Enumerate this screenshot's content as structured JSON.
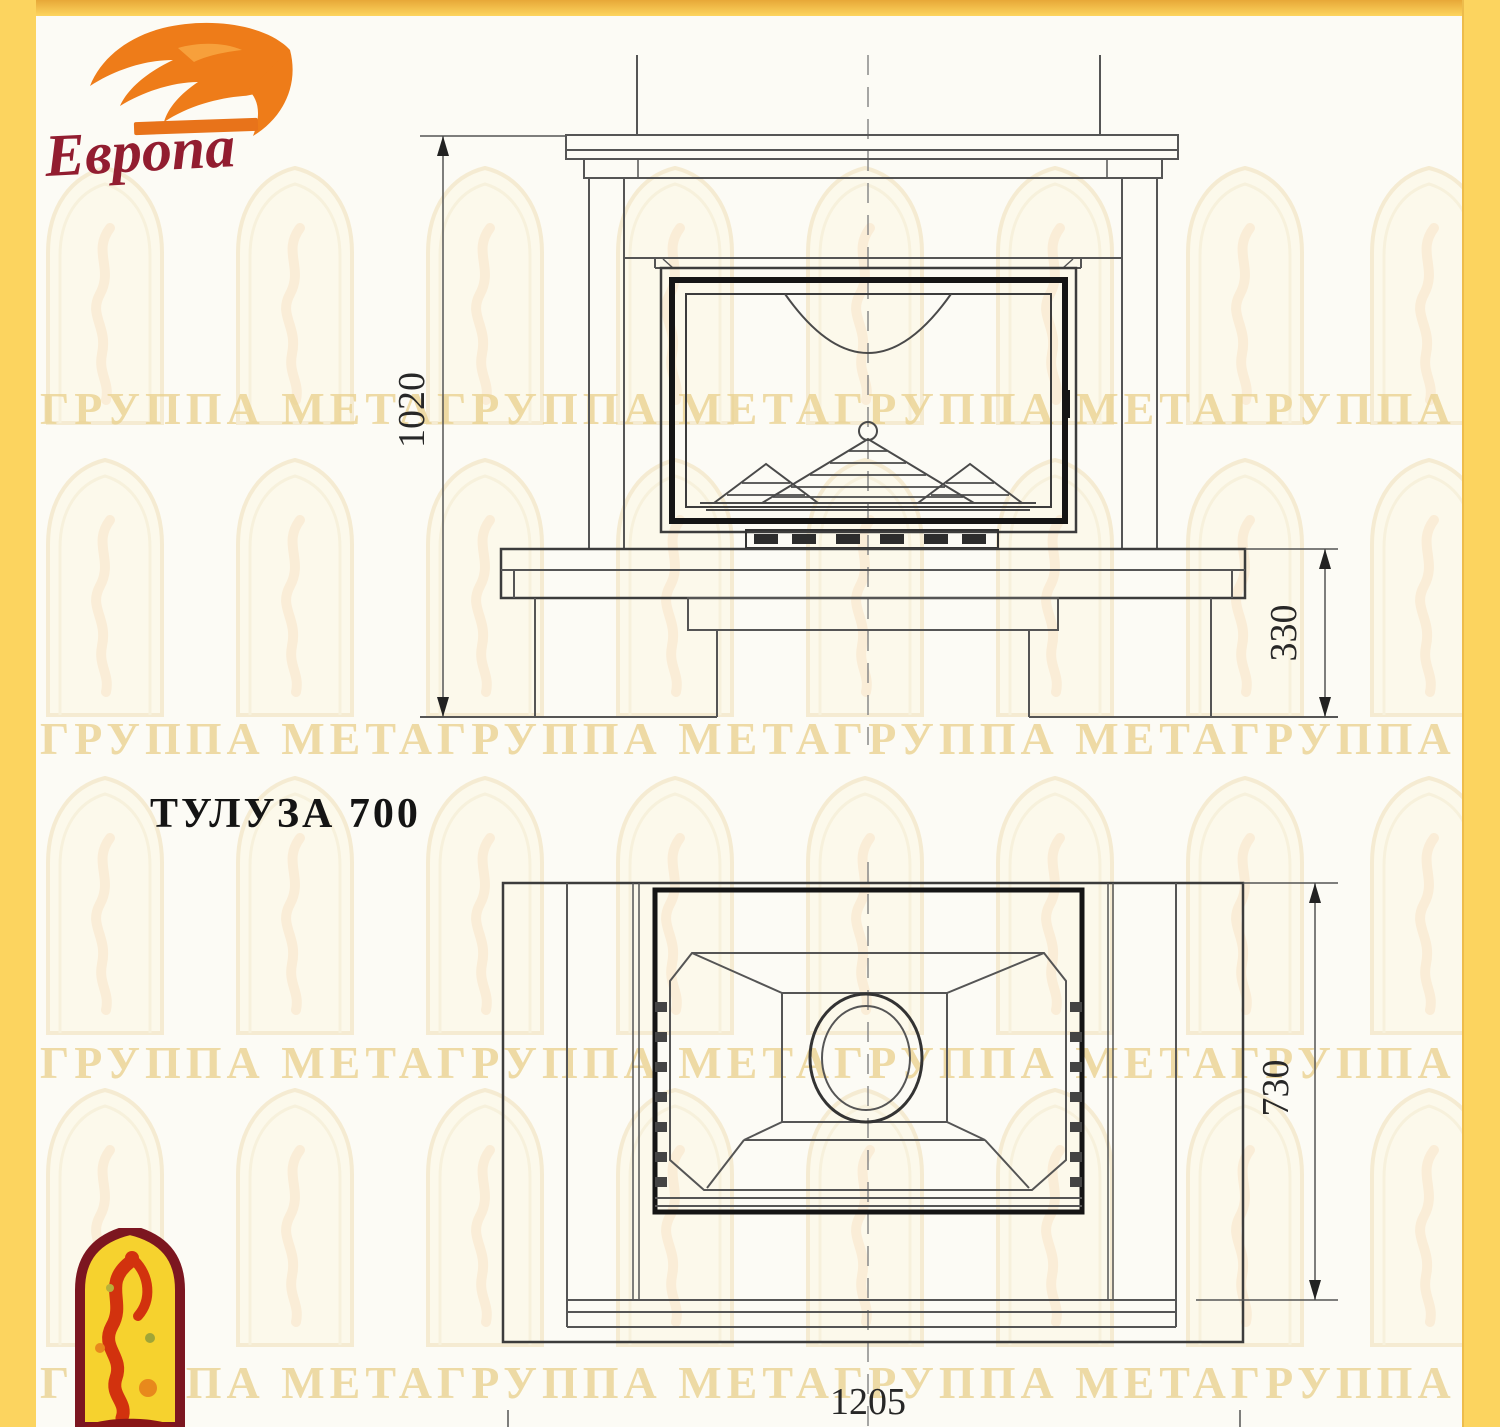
{
  "title": "ТУЛУЗА 700",
  "logo": {
    "brand": "Европа"
  },
  "dimensions": {
    "front_height": "1020",
    "base_height": "330",
    "depth": "730",
    "width": "1205"
  },
  "watermark": {
    "row_text": "ГРУППА МЕТАГРУППА МЕТАГРУППА МЕТАГРУППА МЕТАГРУППА МЕТА"
  },
  "colors": {
    "border_yellow": "#fcd45f",
    "border_amber": "#e7a838",
    "line_gray": "#555555",
    "line_dark": "#161616",
    "brand_red": "#921d30",
    "flame_orange": "#ee7c19",
    "emblem_yellow": "#f6d22e",
    "emblem_maroon": "#7c1620",
    "bird_red": "#d2320e",
    "watermark_tint": "#ead292"
  }
}
